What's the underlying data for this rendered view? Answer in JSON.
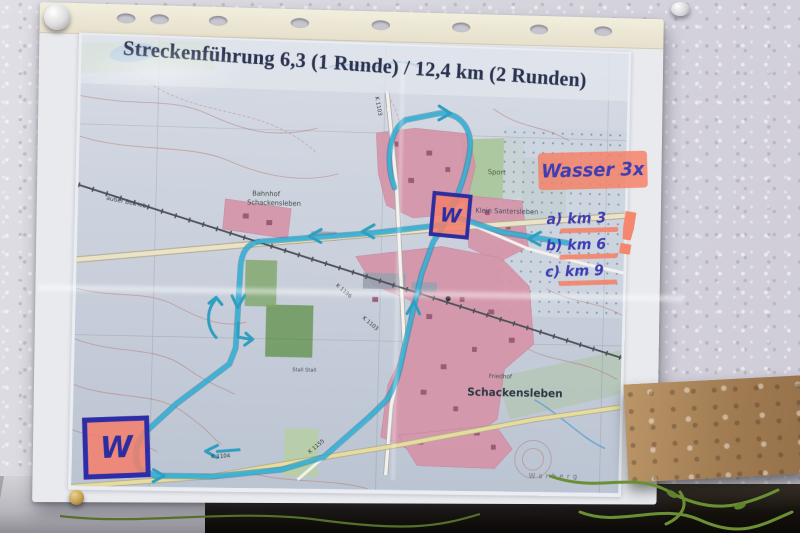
{
  "title": {
    "text": "Streckenführung 6,3 (1 Runde) / 12,4 km (2 Runden)"
  },
  "notes": {
    "wasser": "Wasser 3x",
    "km_marks": [
      "a) km 3",
      "b) km 6",
      "c) km 9"
    ],
    "w_mark_1": "W",
    "w_mark_2": "W",
    "exclamation": "!"
  },
  "map": {
    "labels": {
      "bahnhof_line1": "Bahnhof",
      "bahnhof_line2": "Schackensleben",
      "ausser_betrieb": "außer Betrieb",
      "klein_santersleben": "Klein Santersleben",
      "sport": "Sport",
      "schackensleben": "Schackensleben",
      "friedhof": "Friedhof",
      "stall": "Stall Stall",
      "warberg": "Warberg"
    },
    "roads": {
      "k1103_top": "K 1103",
      "k1196": "K 1196",
      "k1103_mid": "K 1103",
      "k1155": "K 1155",
      "k1104": "K 1104"
    }
  },
  "colors": {
    "route_highlight": "#2f9fc0",
    "pink_highlighter": "#f5826c",
    "handwriting_ink": "#3d3db5",
    "title_ink": "#2a3350",
    "village_pink": "#d693a8",
    "map_base": "#c6ccd6"
  }
}
